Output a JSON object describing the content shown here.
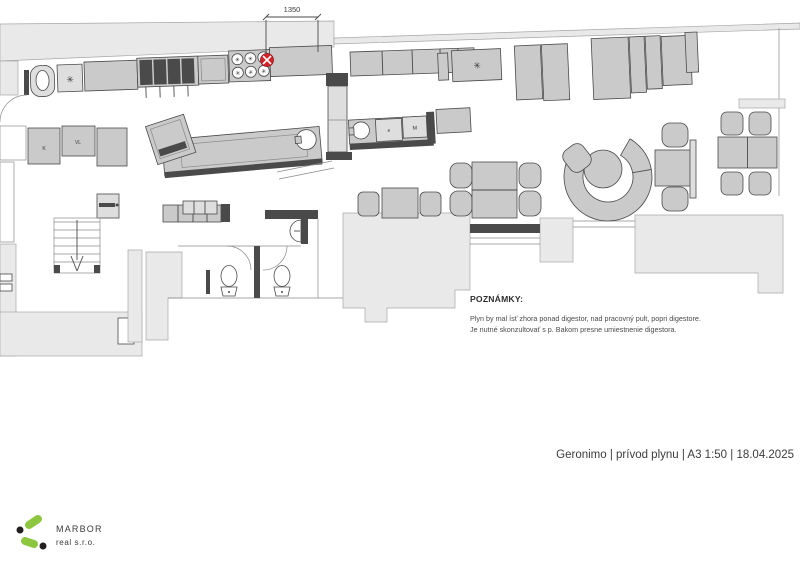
{
  "plan": {
    "dimension_label": "1350",
    "labels": {
      "k": "K",
      "vl": "VL",
      "e": "e",
      "m": "M"
    },
    "symbols": {
      "star": "✳"
    },
    "colors": {
      "gas_marker": "#d4232a",
      "mass": "#e9e9e9",
      "furniture": "#cacaca",
      "wall_dark": "#4a4a4a"
    }
  },
  "notes": {
    "heading": "POZNÁMKY:",
    "lines": [
      "Plyn by mal ísť zhora ponad digestor, nad pracovný pult, popri digestore.",
      "Je nutné skonzultovať s p. Bakom presne umiestnenie digestora."
    ]
  },
  "titleblock": {
    "text": "Geronimo | prívod plynu | A3 1:50 | 18.04.2025"
  },
  "logo": {
    "name": "MARBOR",
    "subtitle": "real s.r.o.",
    "green": "#8dc63f",
    "gray": "#808285"
  }
}
